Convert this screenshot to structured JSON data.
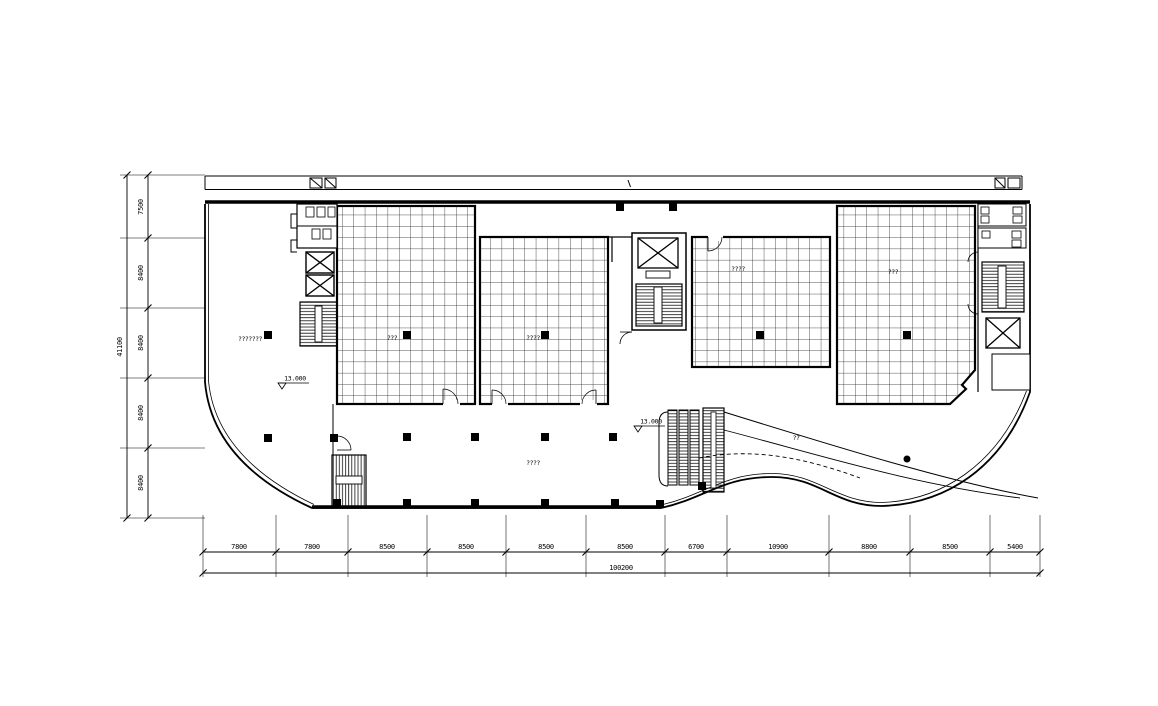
{
  "drawing": {
    "type": "architectural-floor-plan",
    "bg_color": "#ffffff",
    "line_color": "#000000",
    "dims_bottom": {
      "segments": [
        "7800",
        "7800",
        "8500",
        "8500",
        "8500",
        "8500",
        "6700",
        "10900",
        "8800",
        "8500",
        "5400"
      ],
      "total": "100200"
    },
    "dims_left": {
      "segments": [
        "7500",
        "8400",
        "8400",
        "8400",
        "8400"
      ],
      "total": "41100"
    },
    "levels": {
      "left": "13.000",
      "center": "13.000"
    },
    "room_labels": {
      "left_hall": "???????",
      "area_a": "???",
      "area_b": "????",
      "area_c": "????",
      "area_d": "???",
      "lobby": "????",
      "escalator": "??"
    }
  }
}
